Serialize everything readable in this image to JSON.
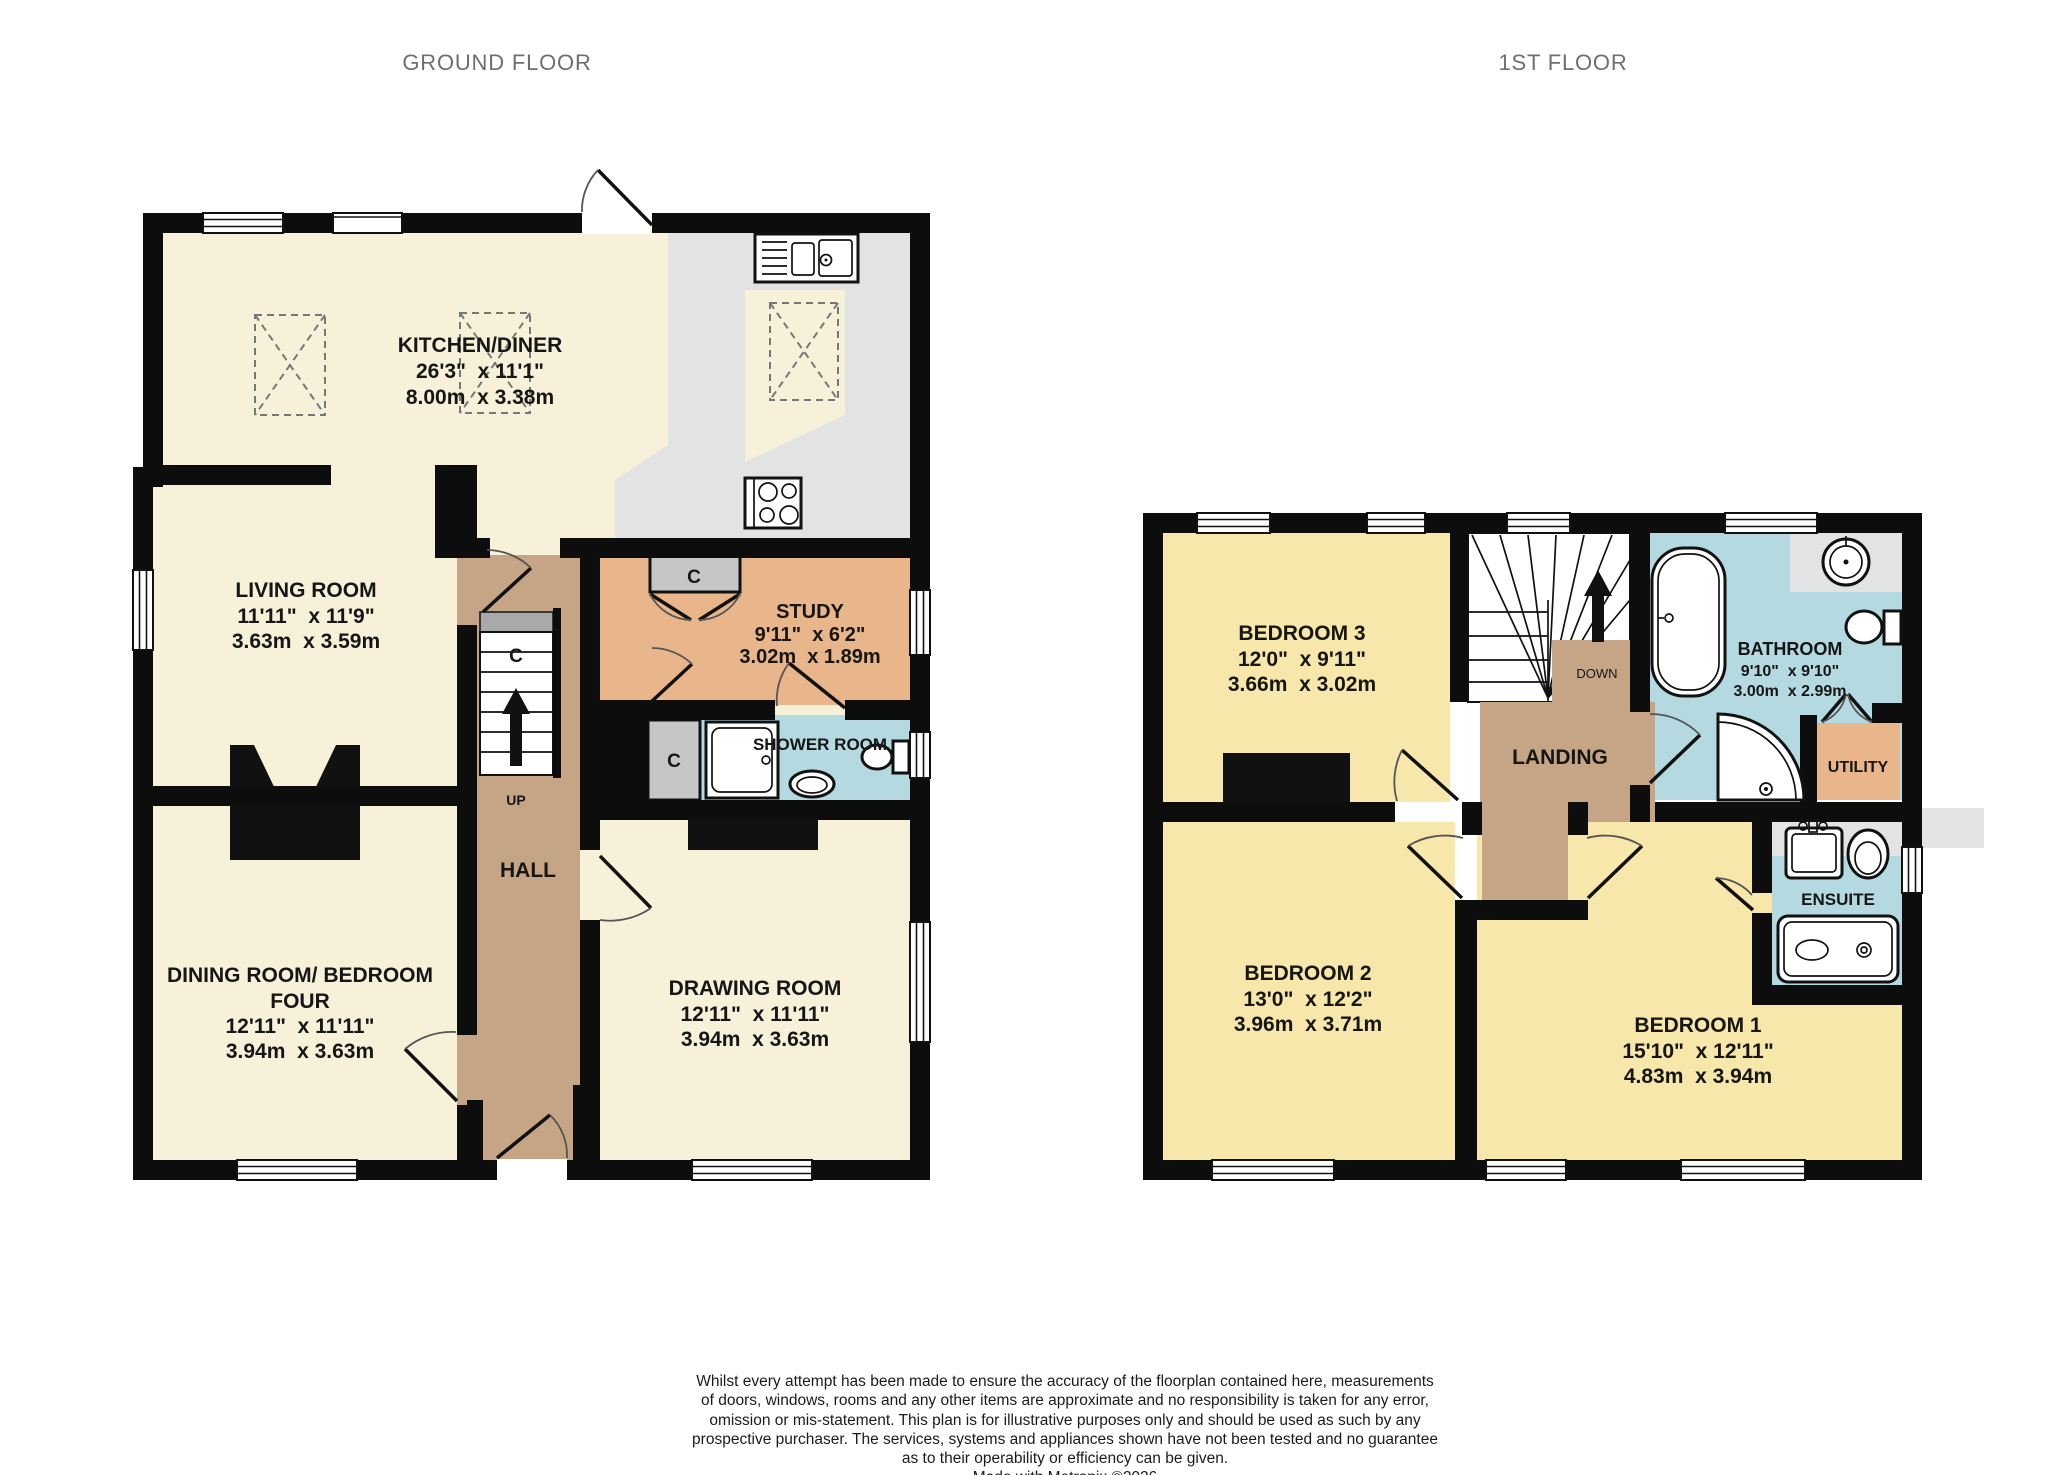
{
  "titles": {
    "ground_floor": "GROUND FLOOR",
    "first_floor": "1ST FLOOR"
  },
  "ground_floor": {
    "kitchen_diner": {
      "name": "KITCHEN/DINER",
      "imperial": "26'3\"  x 11'1\"",
      "metric": "8.00m  x 3.38m"
    },
    "living_room": {
      "name": "LIVING ROOM",
      "imperial": "11'11\"  x 11'9\"",
      "metric": "3.63m  x 3.59m"
    },
    "study": {
      "name": "STUDY",
      "imperial": "9'11\"  x 6'2\"",
      "metric": "3.02m  x 1.89m"
    },
    "shower_room": {
      "name": "SHOWER ROOM"
    },
    "hall": {
      "name": "HALL"
    },
    "dining_room": {
      "name_line1": "DINING ROOM/ BEDROOM",
      "name_line2": "FOUR",
      "imperial": "12'11\"  x 11'11\"",
      "metric": "3.94m  x 3.63m"
    },
    "drawing_room": {
      "name": "DRAWING ROOM",
      "imperial": "12'11\"  x 11'11\"",
      "metric": "3.94m  x 3.63m"
    },
    "stairs_up_label": "UP",
    "cupboard_label": "C"
  },
  "first_floor": {
    "bedroom_3": {
      "name": "BEDROOM 3",
      "imperial": "12'0\"  x 9'11\"",
      "metric": "3.66m  x 3.02m"
    },
    "bedroom_2": {
      "name": "BEDROOM 2",
      "imperial": "13'0\"  x 12'2\"",
      "metric": "3.96m  x 3.71m"
    },
    "bedroom_1": {
      "name": "BEDROOM 1",
      "imperial": "15'10\"  x 12'11\"",
      "metric": "4.83m  x 3.94m"
    },
    "bathroom": {
      "name": "BATHROOM",
      "imperial": "9'10\"  x 9'10\"",
      "metric": "3.00m  x 2.99m"
    },
    "landing": {
      "name": "LANDING"
    },
    "utility": {
      "name": "UTILITY"
    },
    "ensuite": {
      "name": "ENSUITE"
    },
    "stairs_down_label": "DOWN"
  },
  "footer": {
    "line1": "Whilst every attempt has been made to ensure the accuracy of the floorplan contained here, measurements",
    "line2": "of doors, windows, rooms and any other items are approximate and no responsibility is taken for any error,",
    "line3": "omission or mis-statement. This plan is for illustrative purposes only and should be used as such by any",
    "line4": "prospective purchaser. The services, systems and appliances shown have not been tested and no guarantee",
    "line5": "as to their operability or efficiency can be given.",
    "line6": "Made with Metropix ©2026"
  },
  "colors": {
    "room_cream": "#f8f1da",
    "counter_gray": "#e3e3e3",
    "hall_brown": "#c5a585",
    "study_orange": "#e9b58a",
    "bath_blue": "#b4d9e1",
    "bedroom_yellow": "#f7e7aa",
    "cupboard_gray": "#c6c6c6",
    "wall_black": "#0d0d0d",
    "title_gray": "#6f6f6f"
  }
}
